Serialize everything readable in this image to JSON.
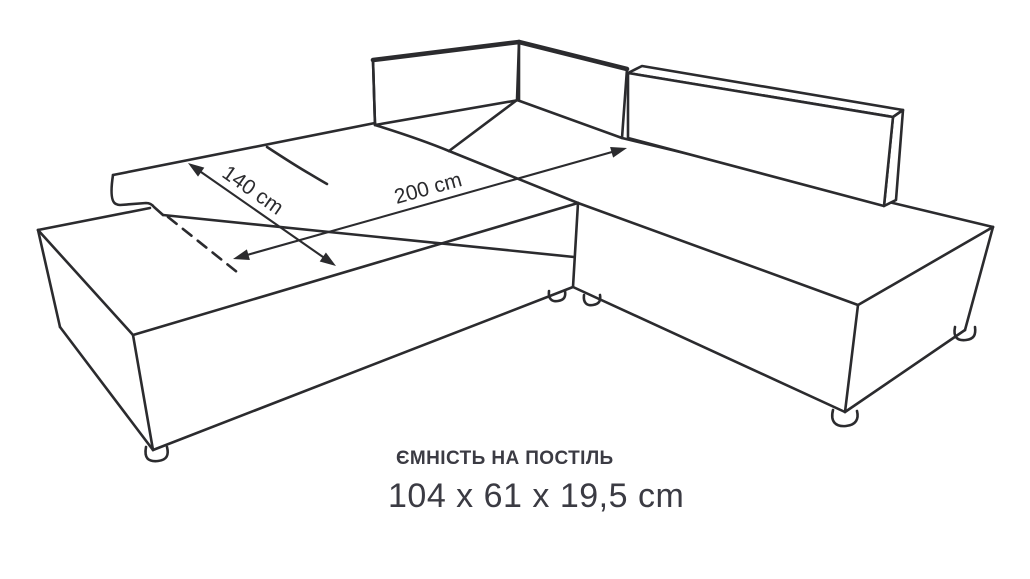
{
  "diagram": {
    "type": "corner-sofa-bed dimension drawing",
    "dimension_labels": {
      "width": "140 cm",
      "length": "200 cm"
    }
  },
  "caption": {
    "title": "ЄМНІСТЬ НА ПОСТІЛЬ",
    "dimensions": "104 x 61 x 19,5 cm"
  },
  "colors": {
    "background": "#ffffff",
    "line": "#2b2b2e",
    "text": "#3b3b43"
  }
}
